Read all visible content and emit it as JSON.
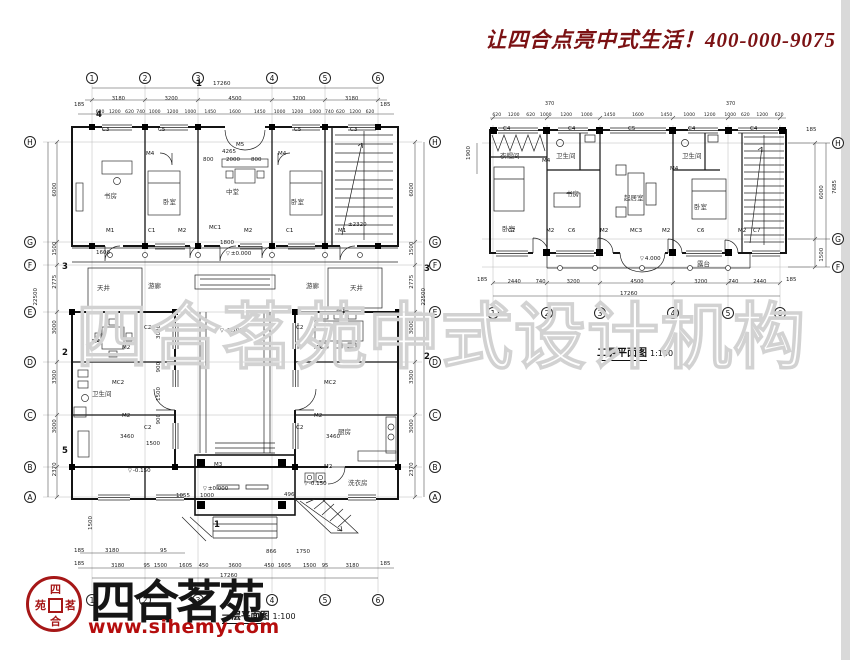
{
  "header": {
    "slogan": "让四合点亮中式生活！400-000-9075"
  },
  "watermark": {
    "text": "四合茗苑中式设计机构"
  },
  "brand": {
    "name": "四合茗苑",
    "website": "www.sihemy.com",
    "seal": [
      "四",
      "茗",
      "合",
      "苑"
    ]
  },
  "plan1": {
    "caption": "一层平面图",
    "scale": "1:100",
    "grid_cols": [
      "1",
      "2",
      "3",
      "4",
      "5",
      "6"
    ],
    "grid_rows": [
      "H",
      "G",
      "F",
      "E",
      "D",
      "C",
      "B",
      "A"
    ],
    "total_w": "17260",
    "total_h": "22500",
    "edge": "185",
    "dims_top_main": [
      "3180",
      "3200",
      "4500",
      "3200",
      "3180"
    ],
    "dims_top_detail": [
      "620",
      "1200",
      "620",
      "740",
      "1000",
      "1200",
      "1000",
      "1450",
      "1600",
      "1450",
      "1000",
      "1200",
      "1000",
      "740",
      "620",
      "1200",
      "620"
    ],
    "dims_left": [
      "6000",
      "1500",
      "2775",
      "3000",
      "3300",
      "3000",
      "2370"
    ],
    "dims_bottom": [
      "3180",
      "95",
      "1500",
      "1605",
      "450",
      "3600",
      "450",
      "1605",
      "1500",
      "95",
      "3180"
    ],
    "dims_bottom_upper": [
      "185",
      "3180",
      "95"
    ],
    "dims_entry": [
      "866",
      "1750",
      "496",
      "1055",
      "1000",
      "1500"
    ],
    "dims_inner": [
      "4265",
      "800",
      "2000",
      "800",
      "1800",
      "1600",
      "3000",
      "900",
      "1500",
      "900",
      "3460",
      "1500",
      "3460"
    ],
    "rooms": {
      "study": "书房",
      "bed_w": "卧室",
      "hall": "中堂",
      "bed_e": "卧室",
      "well_w": "天井",
      "well_e": "天井",
      "gallery_w": "游廊",
      "gallery_e": "游廊",
      "bath": "卫生间",
      "dining": "餐厅",
      "kitchen": "厨房",
      "laundry": "洗衣房"
    },
    "levels": {
      "zero": "±0.000",
      "zero_gate": "±0.000",
      "m015": "-0.150",
      "m015b": "-0.150",
      "m050": "-0.500",
      "stair": "±2320"
    },
    "tags": {
      "top": [
        "C3",
        "C5",
        "M5",
        "C5",
        "C3"
      ],
      "north": [
        "M1",
        "C1",
        "M2",
        "MC1",
        "M2",
        "C1",
        "M1"
      ],
      "west": [
        "M4",
        "M2",
        "MC2",
        "M2",
        "C2",
        "C2"
      ],
      "east": [
        "M2",
        "MC2",
        "M2",
        "C2",
        "C2"
      ],
      "gate": [
        "M3",
        "M2"
      ],
      "inner": [
        "M4",
        "M4"
      ]
    },
    "sections": [
      "1",
      "2",
      "3",
      "4",
      "5"
    ]
  },
  "plan2": {
    "caption": "二层平面图",
    "scale": "1:100",
    "grid_cols": [
      "1",
      "2",
      "3",
      "4",
      "5",
      "6"
    ],
    "grid_rows": [
      "H",
      "G",
      "F"
    ],
    "total_w": "17260",
    "total_h": "7685",
    "edge": "185",
    "dims_top": [
      "620",
      "1200",
      "620",
      "1000",
      "1200",
      "1000",
      "1450",
      "1600",
      "1450",
      "1000",
      "1200",
      "1000",
      "620",
      "1200",
      "620"
    ],
    "dims_top_small": [
      "370",
      "370"
    ],
    "dims_bottom": [
      "2440",
      "740",
      "3200",
      "4500",
      "3200",
      "740",
      "2440"
    ],
    "dims_right": [
      "6000",
      "1500"
    ],
    "dim_left": "1900",
    "level": "4.000",
    "rooms": {
      "bed_l": "卧室",
      "closet": "衣帽间",
      "bath_l": "卫生间",
      "study": "书房",
      "living": "起居室",
      "bed_r": "卧室",
      "bath_r": "卫生间",
      "terrace": "露台"
    },
    "tags": {
      "top": [
        "C4",
        "C4",
        "C5",
        "C4",
        "C4"
      ],
      "bottom": [
        "C7",
        "M2",
        "C6",
        "M2",
        "MC3",
        "M2",
        "C6",
        "M2",
        "C7"
      ],
      "inner": [
        "M4",
        "M4"
      ]
    }
  }
}
